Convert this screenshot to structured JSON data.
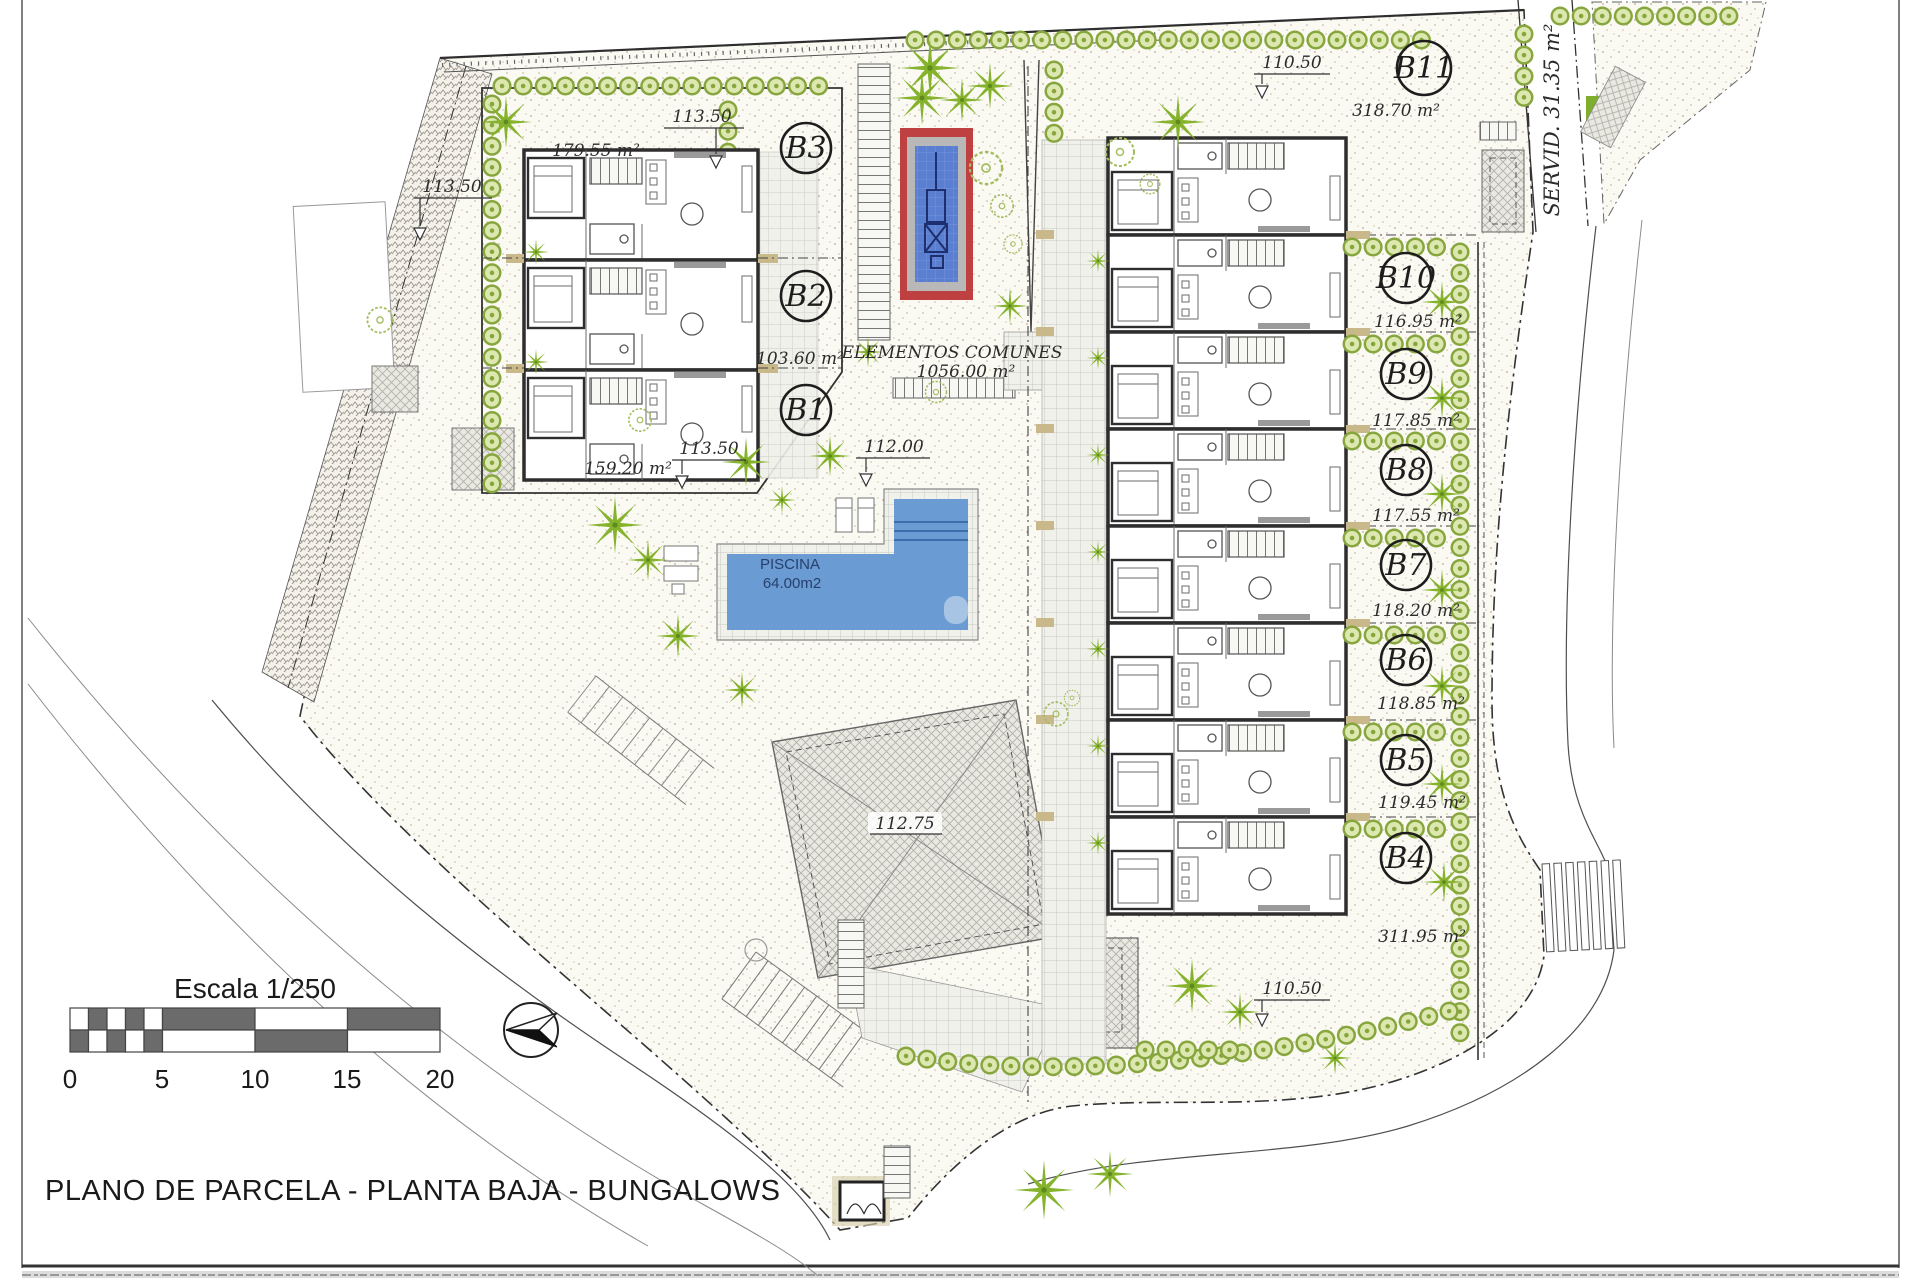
{
  "sheet": {
    "title": "PLANO DE PARCELA - PLANTA BAJA - BUNGALOWS",
    "scale": {
      "label": "Escala 1/250",
      "ticks": [
        "0",
        "5",
        "10",
        "15",
        "20"
      ]
    }
  },
  "plan": {
    "common_area": {
      "label": "ELEMENTOS COMUNES",
      "area": "1056.00 m²"
    },
    "pool": {
      "label": "PISCINA",
      "area": "64.00m2"
    },
    "servitude": {
      "label": "SERVID. 31.35 m²"
    },
    "left_row": {
      "plots": [
        {
          "id": "B3",
          "area": "179.55 m²"
        },
        {
          "id": "B2",
          "area": "103.60 m²"
        },
        {
          "id": "B1",
          "area": "159.20 m²"
        }
      ]
    },
    "right_row": {
      "plots": [
        {
          "id": "B11",
          "area": "318.70 m²"
        },
        {
          "id": "B10",
          "area": "116.95 m²"
        },
        {
          "id": "B9",
          "area": "117.85 m²"
        },
        {
          "id": "B8",
          "area": "117.55 m²"
        },
        {
          "id": "B7",
          "area": "118.20 m²"
        },
        {
          "id": "B6",
          "area": "118.85 m²"
        },
        {
          "id": "B5",
          "area": "119.45 m²"
        },
        {
          "id": "B4",
          "area": "311.95 m²"
        }
      ]
    },
    "levels": {
      "left_band": "113.50",
      "left_top": "113.50",
      "left_bottom": "113.50",
      "center": "112.00",
      "plaza": "112.75",
      "right_top": "110.50",
      "right_bottom": "110.50"
    }
  }
}
